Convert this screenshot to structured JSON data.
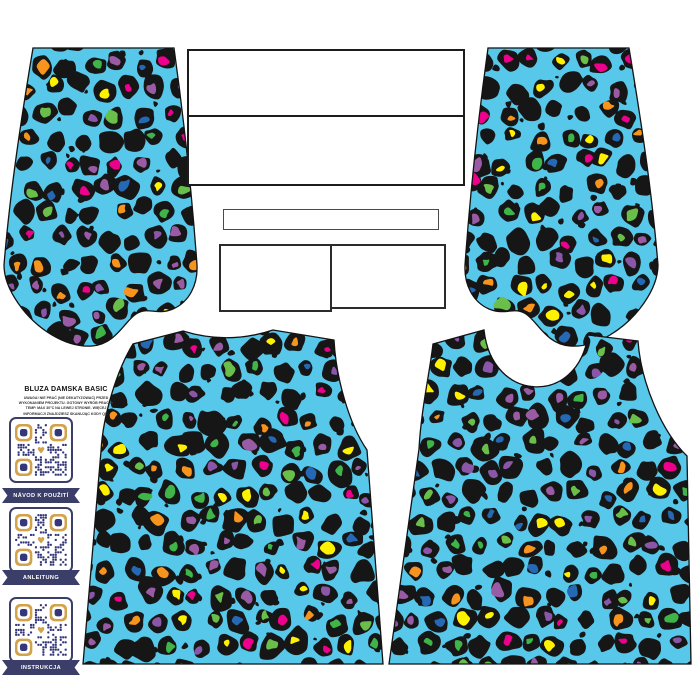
{
  "sheet": {
    "title": "BLUZA DAMSKA BASIC",
    "instructions_lines": [
      "UWAGA! NIE PRAĆ (NIE DEKATYZOWAĆ) PRZED",
      "WYKONANIEM PROJEKTU. GOTOWY WYRÓB PRAĆ W",
      "TEMP. MAX 30°C NA LEWEJ STRONIE. WIĘCEJ",
      "INFORMACJI ZNAJDZIESZ SKANUJĄC KODY QR."
    ],
    "qr_labels": [
      "NÁVOD K POUŽITÍ",
      "ANLEITUNG",
      "INSTRUKCJA"
    ]
  },
  "fabric": {
    "background_color": "#57C7EA",
    "rosette_color": "#161616",
    "outline_color": "#121212",
    "spot_colors": [
      "#EC008C",
      "#FFF200",
      "#F7941D",
      "#3FB549",
      "#8A56A8",
      "#2569B5",
      "#6ABF4B",
      "#9A5BA5"
    ]
  },
  "badge": {
    "ribbon_color": "#3A3E68",
    "qr_color": "#34387B",
    "qr_accent_color": "#D2A24C"
  }
}
